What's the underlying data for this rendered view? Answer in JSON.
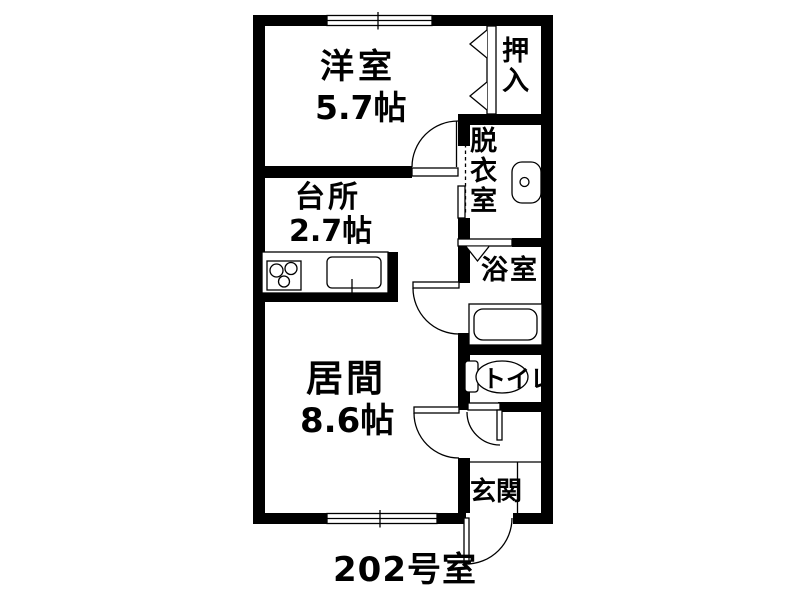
{
  "colors": {
    "wall": "#000000",
    "background": "#ffffff"
  },
  "unit": {
    "label": "202号室"
  },
  "rooms": {
    "yoshitsu": {
      "label": "洋室",
      "size": "5.7帖"
    },
    "daidokoro": {
      "label": "台所",
      "size": "2.7帖"
    },
    "ima": {
      "label": "居間",
      "size": "8.6帖"
    },
    "oshiire": {
      "label": "押入"
    },
    "datsuishitsu": {
      "label": "脱衣室"
    },
    "yokushitsu": {
      "label": "浴室"
    },
    "toire": {
      "label": "トイレ"
    },
    "genkan": {
      "label": "玄関"
    }
  }
}
